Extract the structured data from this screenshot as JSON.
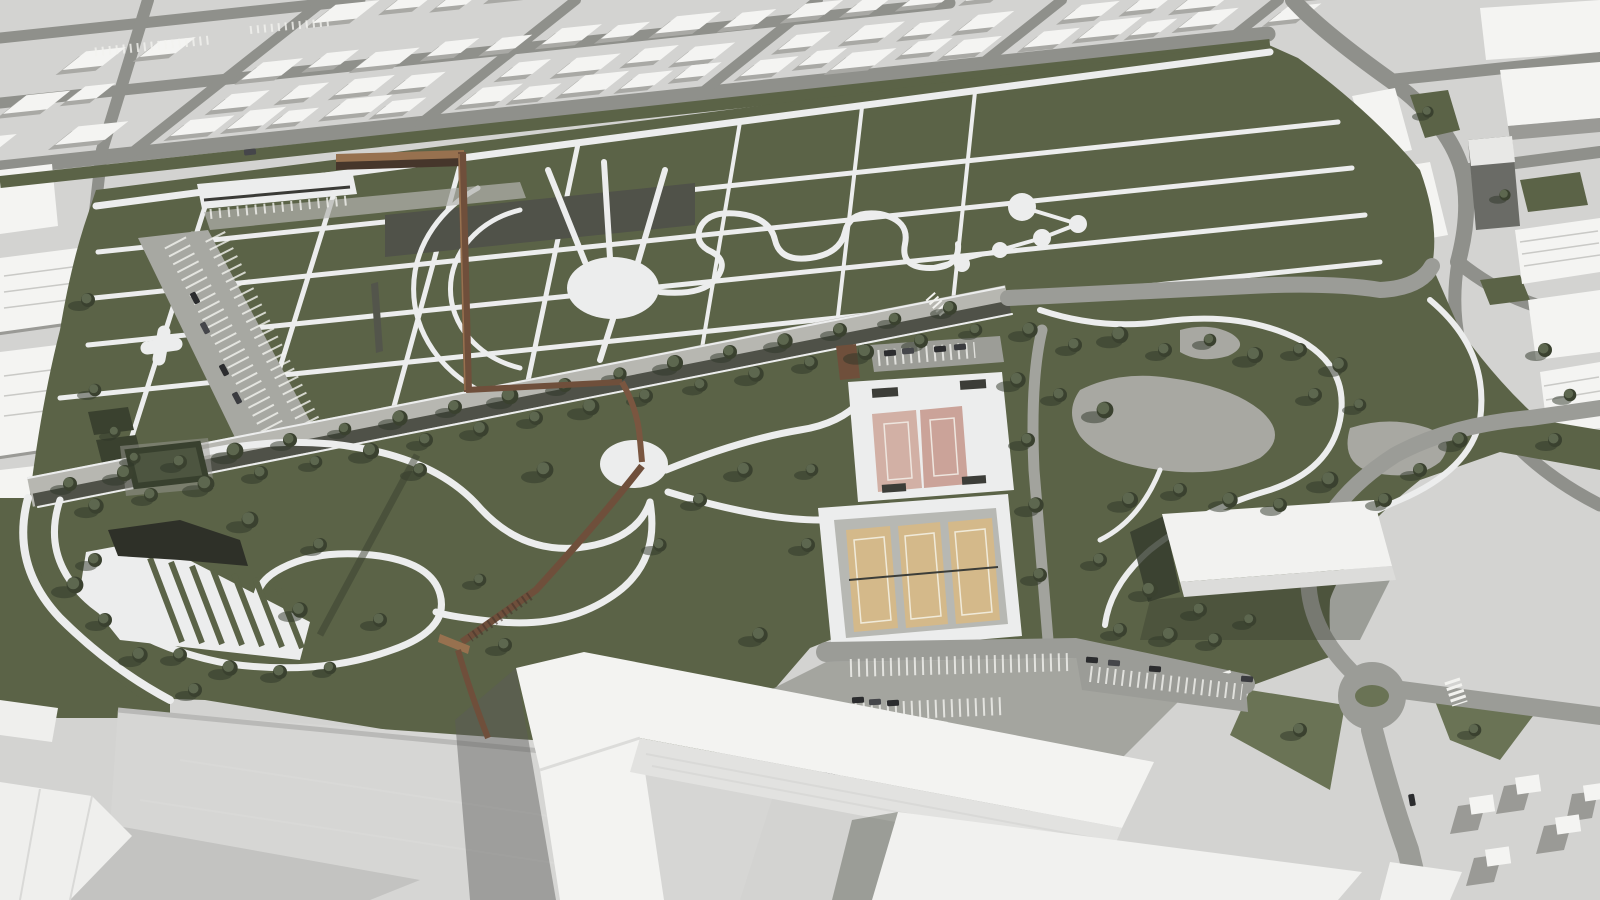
{
  "meta": {
    "type": "3d-aerial-architectural-rendering",
    "subject": "urban park masterplan set inside a white massing-model city",
    "view": "oblique bird's-eye view",
    "lighting": "sun from upper right, long soft shadows cast to lower left",
    "palette": "monochrome white/grey city with olive-green parkland"
  },
  "colors": {
    "city_ground": "#d3d3d1",
    "city_road": "#8f908b",
    "city_building": "#f4f4f2",
    "city_building_shadow": "#a9a9a5",
    "grass": "#5b6347",
    "grass_dark": "#47503a",
    "grass_light": "#6a7355",
    "tree_canopy": "#3a412f",
    "tree_canopy_light": "#5d674f",
    "tree_shadow": "#2e3527",
    "path_white": "#eceded",
    "promenade_gravel": "#b7b7b1",
    "promenade_asphalt": "#4f5148",
    "park_road": "#9b9c97",
    "pavement": "#a2a39d",
    "gravel_plaza": "#a8a8a2",
    "water_dark": "#2e3028",
    "dark_strip": "#505249",
    "court_pink": "#d2b0a5",
    "court_pink_2": "#cba399",
    "court_tan": "#d4b98a",
    "plaza_gray": "#b7b8b3",
    "bridge_rust": "#6f4f3b",
    "bridge_rust_light": "#97714f",
    "bridge_rust_dark": "#46362b",
    "hall_white": "#f2f2f0",
    "hall_face": "#dcdcda",
    "ground_shadow": "#333a2c",
    "car_dark": "#2b2c2e",
    "roof_wedge": "#d6d6d4",
    "roof_wedge_dark": "#c3c3c1"
  },
  "scene": {
    "districts": [
      "north-city-blocks",
      "east-city-blocks",
      "west-city-edge",
      "southeast-city-corner"
    ],
    "park": {
      "upper_formal_garden": [
        "orthogonal path grid",
        "plus-shaped path nodes",
        "large circular plaza with radiating spokes",
        "concentric arc paths",
        "dark reflecting strip",
        "serpentine path with round pond plazas",
        "grandstand canopy",
        "angled parking lot"
      ],
      "tree_promenade": [
        "double tree allee",
        "dark asphalt lane",
        "gravel walk",
        "crosswalk"
      ],
      "lower_park": [
        "looping trails",
        "terraced amphitheater ramps",
        "dark pond",
        "small circular plaza",
        "square hedge grove"
      ],
      "east_woodland": [
        "tree grid",
        "organic gravel clearings",
        "winding trails"
      ]
    },
    "sports_complex": {
      "basketball_courts": 2,
      "tennis_courts": 3,
      "pavilion": 1,
      "benches": true
    },
    "skywalk": "elevated corten-steel walkway: runs along the avenue, turns, crosses garden and promenade, descends past a circular plaza to the museum forecourt",
    "event_hall": "large white flat-roofed hall east of the tennis courts",
    "infrastructure": {
      "roundabout": 1,
      "parking_lots": 4,
      "crosswalks": 3,
      "cars_visible": 18
    },
    "foreground": [
      "large V-shaped white museum building",
      "wide grey roof wedges",
      "white slab buildings",
      "small houses with long shadows"
    ]
  }
}
